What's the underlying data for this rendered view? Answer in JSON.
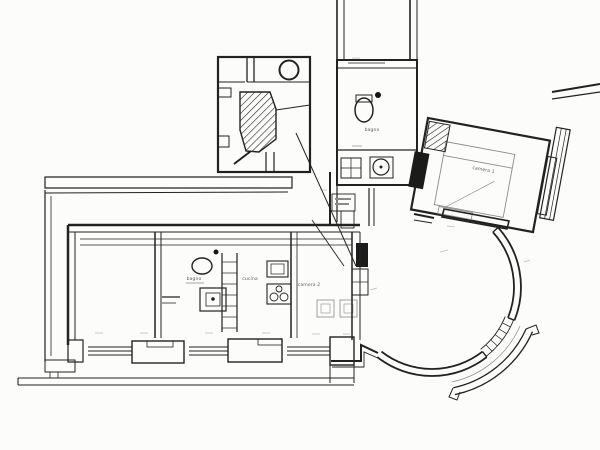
{
  "plan": {
    "title": "apartment floor plan (scanned drawing)",
    "labels": {
      "bathroom_upper": "bagno",
      "bedroom": "camera 1",
      "bathroom_lower": "bagno",
      "kitchen": "cucina",
      "room2": "camera 2"
    },
    "colors": {
      "ink": "#222222",
      "paper": "#fcfcfb",
      "faint_marks": "#8a8a8a"
    }
  }
}
